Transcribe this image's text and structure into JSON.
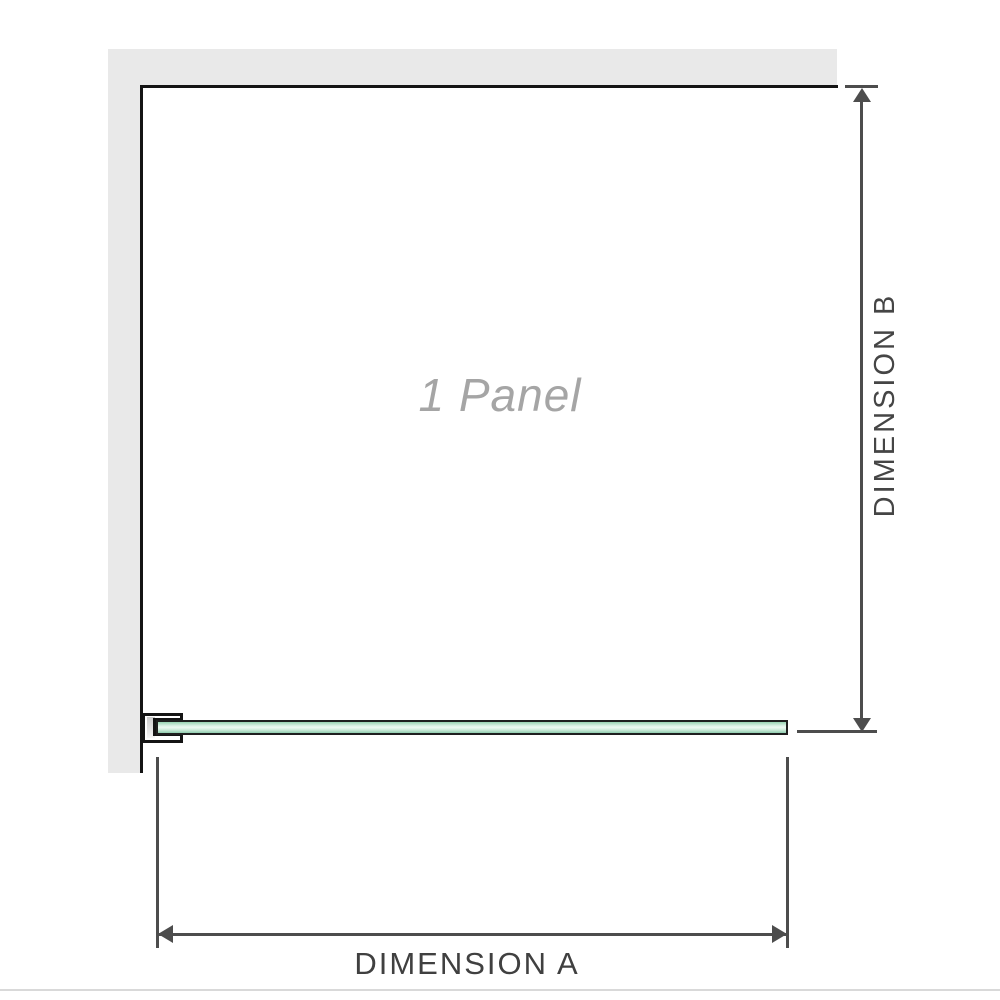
{
  "diagram": {
    "title": "Shower screen single panel dimension diagram",
    "panel_label": "1 Panel",
    "dimension_a_label": "DIMENSION A",
    "dimension_b_label": "DIMENSION B",
    "panel_count": 1
  },
  "icons": {
    "arrow_up": "arrowhead-up-icon",
    "arrow_down": "arrowhead-down-icon",
    "arrow_left": "arrowhead-left-icon",
    "arrow_right": "arrowhead-right-icon"
  },
  "colors": {
    "background": "#ffffff",
    "wall_fill": "#e9e9e9",
    "panel_outline": "#141414",
    "glass_green_top": "#98d3b2",
    "glass_green_highlight": "#eef9f2",
    "glass_green_bottom": "#8fccae",
    "glass_outline": "#1f1f1f",
    "dimension_line": "#4d4d4d",
    "dimension_text": "#454545",
    "watermark_text": "#a5a5a5",
    "separator": "#d9d9d9"
  }
}
